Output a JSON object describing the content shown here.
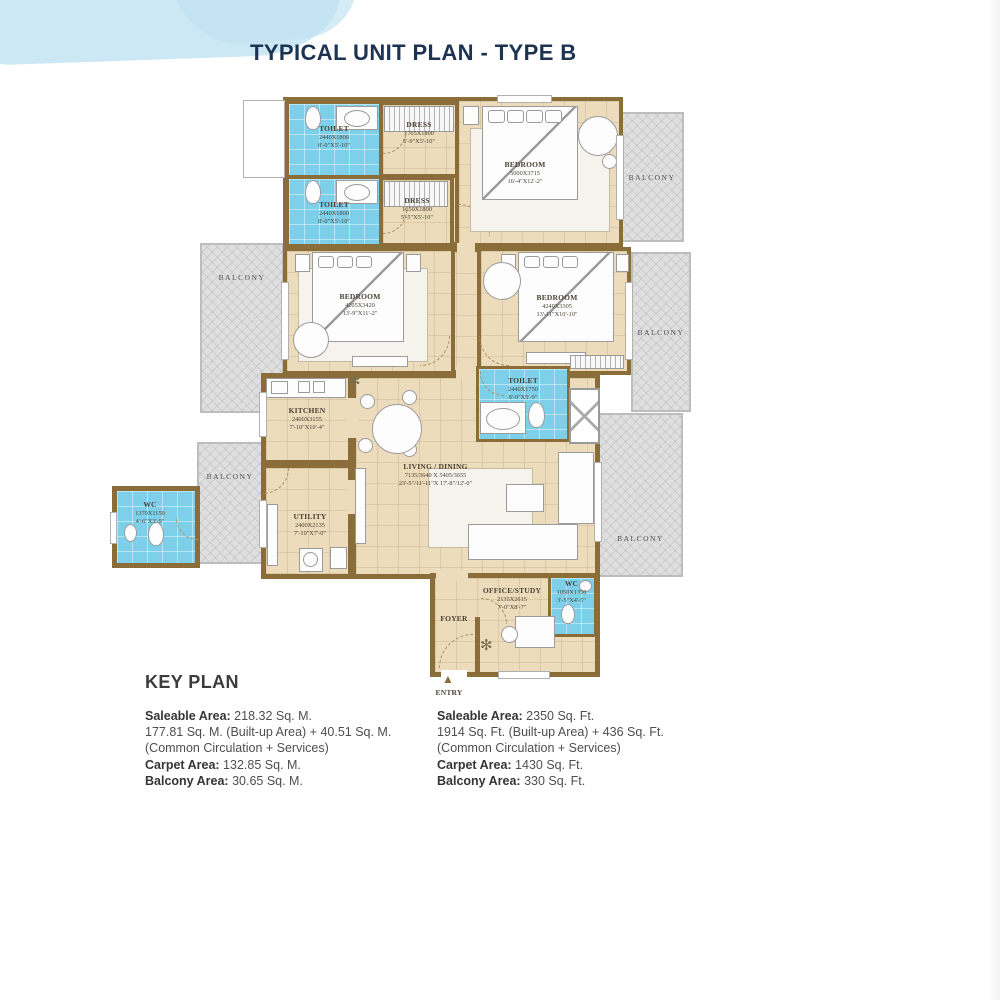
{
  "page": {
    "title": "TYPICAL UNIT PLAN - TYPE B"
  },
  "labels": {
    "balcony": "BALCONY",
    "entry": "ENTRY"
  },
  "rooms": {
    "toilet1": {
      "name": "TOILET",
      "mm": "2440X1800",
      "ft": "8'-0\"X5'-10\""
    },
    "dress1": {
      "name": "DRESS",
      "mm": "1765X1800",
      "ft": "5'-9\"X5'-10\""
    },
    "toilet2": {
      "name": "TOILET",
      "mm": "2440X1800",
      "ft": "8'-0\"X5'-10\""
    },
    "dress2": {
      "name": "DRESS",
      "mm": "1650X1800",
      "ft": "5'-5\"X5'-10\""
    },
    "bedroom1": {
      "name": "BEDROOM",
      "mm": "5000X3715",
      "ft": "16'-4\"X12'-2\""
    },
    "bedroom2": {
      "name": "BEDROOM",
      "mm": "4205X3420",
      "ft": "13'-9\"X11'-2\""
    },
    "bedroom3": {
      "name": "BEDROOM",
      "mm": "4240X3305",
      "ft": "13'-11\"X10'-10\""
    },
    "kitchen": {
      "name": "KITCHEN",
      "mm": "2400X3155",
      "ft": "7'-10\"X10'-4\""
    },
    "toilet3": {
      "name": "TOILET",
      "mm": "2440X1750",
      "ft": "8'-0\"X5'-9\""
    },
    "living": {
      "name": "LIVING / DINING",
      "mm": "7135/3640 X 5405/3655",
      "ft": "23'-5\"/11'-11\"X 17'-8\"/12'-0\""
    },
    "utility": {
      "name": "UTILITY",
      "mm": "2400X2135",
      "ft": "7'-10\"X7'-0\""
    },
    "wc_left": {
      "name": "WC",
      "mm": "1370X1150",
      "ft": "4'-6\"X3'-9\""
    },
    "office": {
      "name": "OFFICE/STUDY",
      "mm": "2135X2615",
      "ft": "7'-0\"X8'-7\""
    },
    "wc_right": {
      "name": "WC",
      "mm": "1050X1350",
      "ft": "3'-5\"X4'-5\""
    },
    "foyer": {
      "name": "FOYER"
    }
  },
  "keyplan": {
    "heading": "KEY PLAN",
    "metric": {
      "saleable_label": "Saleable Area:",
      "saleable_value": " 218.32 Sq. M.",
      "builtup_line": "177.81 Sq. M. (Built-up Area) + 40.51 Sq. M.",
      "common_line": "(Common Circulation + Services)",
      "carpet_label": "Carpet Area:",
      "carpet_value": " 132.85 Sq. M.",
      "balcony_label": "Balcony Area:",
      "balcony_value": " 30.65 Sq. M."
    },
    "imperial": {
      "saleable_label": "Saleable Area:",
      "saleable_value": " 2350 Sq. Ft.",
      "builtup_line": "1914 Sq. Ft. (Built-up Area) + 436 Sq. Ft.",
      "common_line": "(Common Circulation + Services)",
      "carpet_label": "Carpet Area:",
      "carpet_value": " 1430 Sq. Ft.",
      "balcony_label": "Balcony Area:",
      "balcony_value": " 330 Sq. Ft."
    }
  },
  "colors": {
    "wall": "#8b6d3a",
    "floor": "#ecdcbc",
    "wet_area": "#7ed0ea",
    "balcony": "#dfdfdf",
    "title": "#1d3352"
  }
}
